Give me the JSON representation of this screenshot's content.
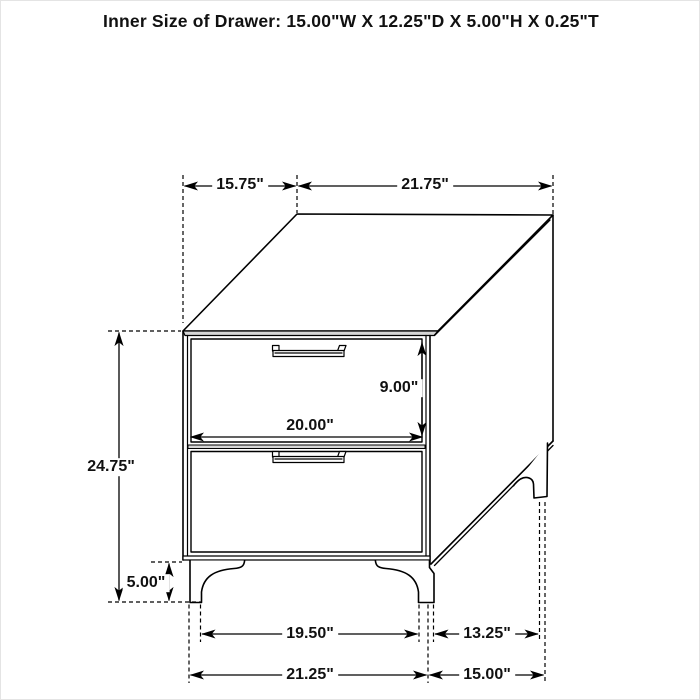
{
  "title": "Inner Size of Drawer: 15.00\"W X 12.25\"D X 5.00\"H X 0.25\"T",
  "dimensions": {
    "top_depth": "15.75\"",
    "top_width": "21.75\"",
    "overall_height": "24.75\"",
    "leg_height": "5.00\"",
    "drawer_front_height": "9.00\"",
    "drawer_front_width": "20.00\"",
    "base_inner_width": "19.50\"",
    "base_inner_depth": "13.25\"",
    "base_width": "21.25\"",
    "base_depth": "15.00\""
  },
  "colors": {
    "line": "#000000",
    "panel_band": "#d6d6d6",
    "background": "#ffffff"
  }
}
